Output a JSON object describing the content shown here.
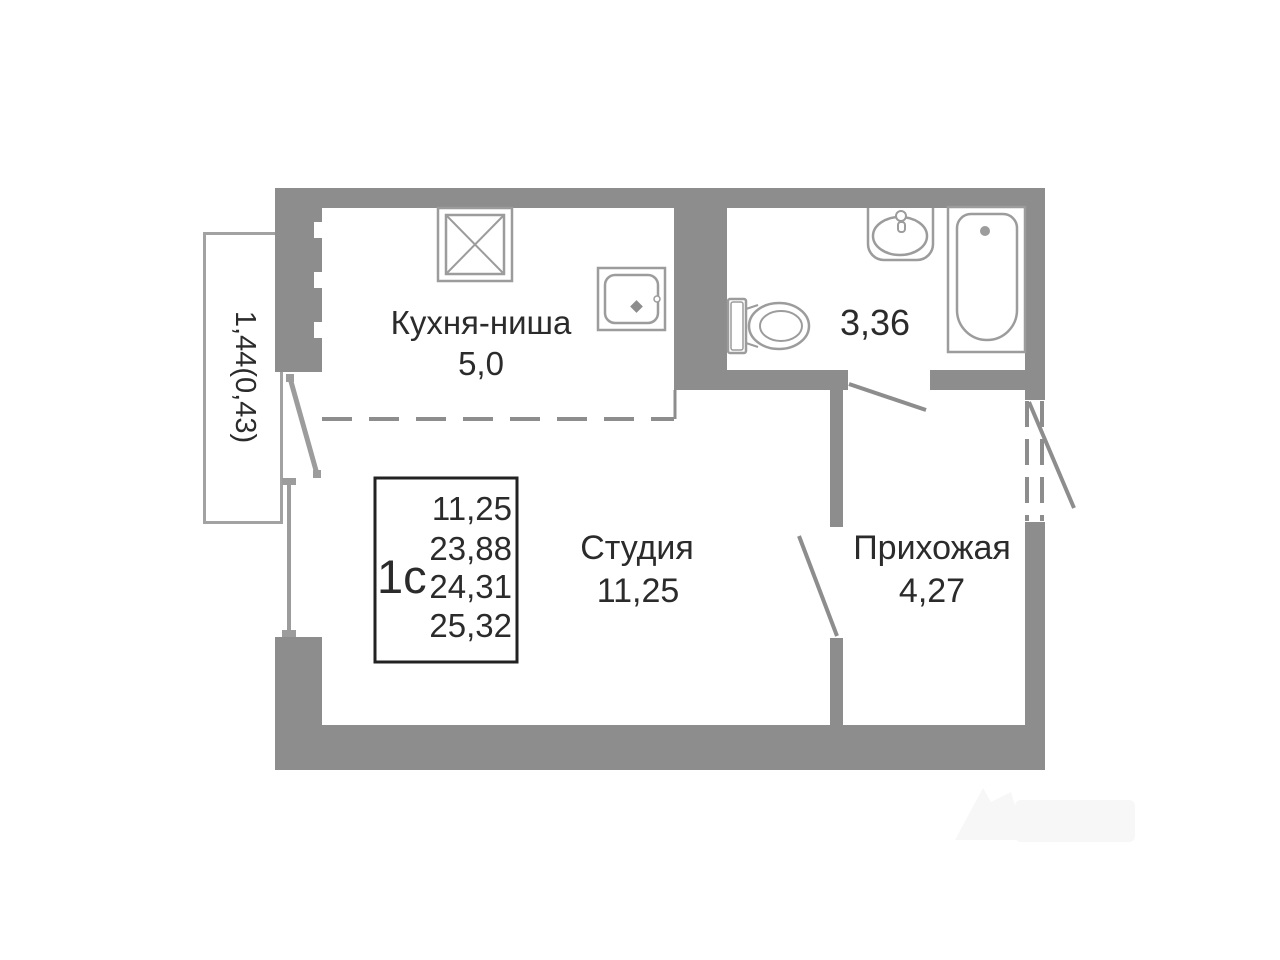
{
  "plan": {
    "background": "#ffffff",
    "colors": {
      "wall": "#8d8d8d",
      "fixture": "#9c9c9c",
      "text": "#2b2b2b",
      "info_border": "#222222",
      "balcony_outline": "#a2a2a2"
    },
    "rooms": {
      "kitchen": {
        "label": "Кухня-ниша",
        "area": "5,0"
      },
      "studio": {
        "label": "Студия",
        "area": "11,25"
      },
      "hallway": {
        "label": "Прихожая",
        "area": "4,27"
      },
      "bathroom": {
        "area": "3,36"
      },
      "balcony": {
        "area": "1,44(0,43)"
      }
    },
    "info_box": {
      "unit_type": "1с",
      "values": [
        "11,25",
        "23,88",
        "24,31",
        "25,32"
      ]
    },
    "fixtures": [
      "vent-shaft-icon",
      "kitchen-sink-icon",
      "toilet-icon",
      "washbasin-icon",
      "bathtub-icon"
    ]
  }
}
